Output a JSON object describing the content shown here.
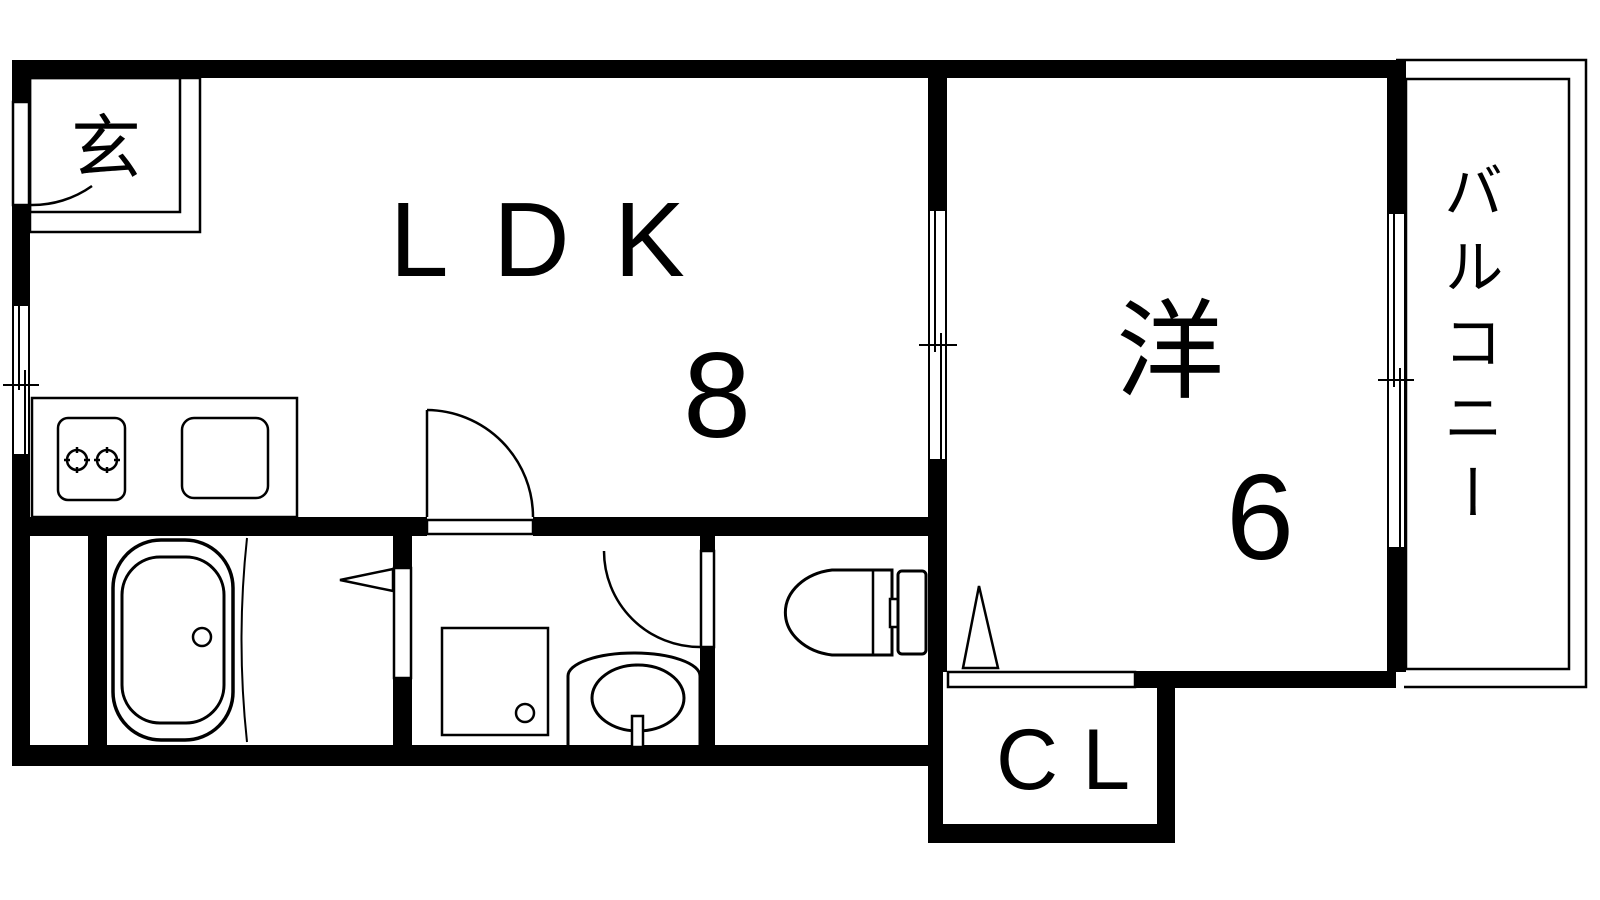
{
  "plan": {
    "type": "japanese-apartment-floor-plan",
    "rooms": {
      "entrance": {
        "label": "玄"
      },
      "ldk": {
        "label": "LDK",
        "size_tatami": "8"
      },
      "western_room": {
        "label": "洋",
        "size_tatami": "6"
      },
      "closet": {
        "label": "CL"
      },
      "balcony": {
        "label": "バルコニー"
      }
    },
    "fixtures": [
      "kitchen-counter",
      "gas-stove-two-burners",
      "kitchen-sink",
      "bathtub",
      "washing-machine-pan",
      "washbasin-vanity",
      "toilet"
    ],
    "doors": [
      "entrance-door-swing",
      "ldk-door-swing",
      "bathroom-folding-door",
      "toilet-door-swing",
      "closet-folding-door"
    ],
    "windows": [
      "left-wall-window",
      "ldk-western-room-sliding-door",
      "western-room-balcony-window"
    ],
    "colors": {
      "wall": "#000000",
      "line": "#000000",
      "background": "#ffffff"
    }
  }
}
